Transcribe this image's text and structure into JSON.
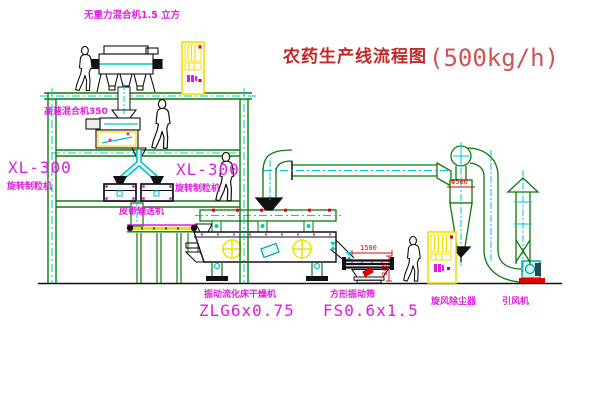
{
  "title": {
    "text": "农药生产线流程图",
    "capacity": "(500kg/h)"
  },
  "equipment": {
    "gravity_mixer_label": "无重力混合机1.5 立方",
    "high_speed_mixer_label": "高速混合机350",
    "granulator_left": {
      "model": "XL-300",
      "name": "旋转制粒机"
    },
    "granulator_middle": {
      "model": "XL-300",
      "name": "旋转制粒机"
    },
    "belt_conveyor_label": "皮带输送机",
    "fluid_bed_dryer": {
      "name": "振动流化床干燥机",
      "model": "ZLG6x0.75"
    },
    "vibrating_screen": {
      "name": "方形振动筛",
      "model": "FS0.6x1.5"
    },
    "cyclone": {
      "name": "旋风除尘器"
    },
    "induced_draft_fan": {
      "name": "引风机"
    }
  },
  "dimensions": {
    "cyclone_diameter": "Φ500",
    "screen_length": "1500",
    "screen_height": "345"
  },
  "colors": {
    "line_green": "#0b7a0b",
    "centerline_cyan": "#00c8c8",
    "label_magenta": "#e01ce0",
    "cabinet_yellow": "#f0e000",
    "dimension_red": "#e00000",
    "title_red": "#c32727",
    "background": "#ffffff"
  }
}
